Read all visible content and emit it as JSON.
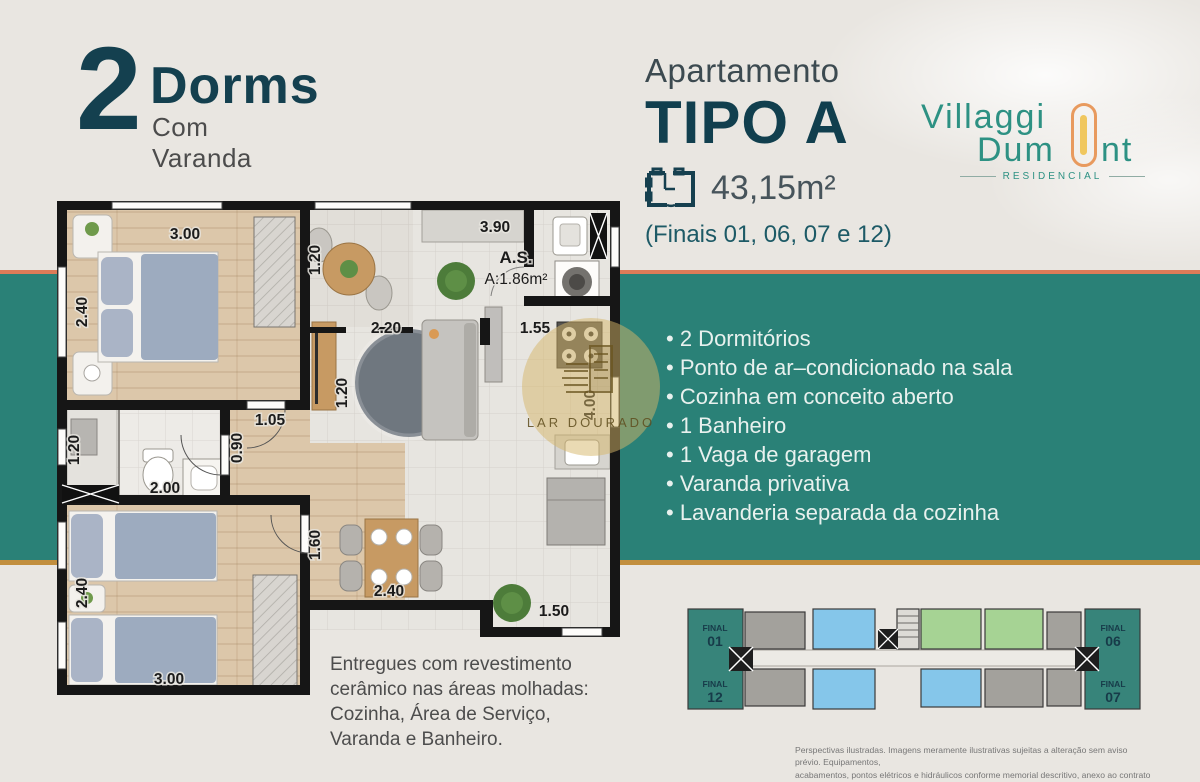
{
  "colors": {
    "background": "#e9e6e1",
    "band_teal": "#2a8177",
    "band_top_accent": "#dd7b58",
    "band_bottom_accent": "#c28f3e",
    "headline": "#14404f",
    "logo_teal": "#2d9183",
    "logo_orange": "#e89a5e",
    "logo_yellow": "#f0c75e",
    "keyplan_unit_blue": "#85c6ea",
    "keyplan_unit_green": "#a6d394",
    "keyplan_unit_gray": "#a3a19c",
    "keyplan_unit_teal": "#37847a"
  },
  "header_left": {
    "big_number": "2",
    "title": "Dorms",
    "subtitle": "Com Varanda"
  },
  "header_center": {
    "kicker": "Apartamento",
    "type": "TIPO A",
    "area": "43,15m²",
    "finals": "(Finais 01, 06, 07 e 12)"
  },
  "logo": {
    "word1": "Villaggi",
    "word2a": "Dum",
    "word2b": "nt",
    "tagline": "RESIDENCIAL"
  },
  "features": {
    "items": [
      "2 Dormitórios",
      "Ponto de ar–condicionado na sala",
      "Cozinha em conceito aberto",
      "1 Banheiro",
      "1 Vaga de garagem",
      "Varanda privativa",
      "Lavanderia separada da cozinha"
    ]
  },
  "floorplan": {
    "labels": {
      "bed1_top": "3.00",
      "bed1_left": "2.40",
      "varanda_w": "1.20",
      "kitchen_top": "3.90",
      "living_w": "2.20",
      "as_title": "A.S.",
      "as_area": "A:1.86m²",
      "kitchen_w": "1.55",
      "tv_wall": "1.20",
      "right_h": "4.00",
      "bath_h": "1.20",
      "bath_w": "2.00",
      "hall_w": "1.05",
      "hall_h": "0.90",
      "dining_h": "1.60",
      "dining_w": "2.40",
      "bed2_left": "2.40",
      "bed2_bottom": "3.00",
      "service_w": "1.50"
    }
  },
  "watermark": {
    "text": "LAR DOURADO"
  },
  "delivery_note": {
    "text": "Entregues com revestimento\ncerâmico nas áreas molhadas:\nCozinha, Área de Serviço,\nVaranda e Banheiro."
  },
  "keyplan": {
    "units": [
      {
        "label": "FINAL",
        "number": "01"
      },
      {
        "label": "FINAL",
        "number": "12"
      },
      {
        "label": "FINAL",
        "number": "06"
      },
      {
        "label": "FINAL",
        "number": "07"
      }
    ]
  },
  "disclaimer": {
    "text": "Perspectivas ilustradas. Imagens meramente ilustrativas sujeitas a alteração sem aviso prévio. Equipamentos,\nacabamentos, pontos elétricos e hidráulicos conforme memorial descritivo, anexo ao contrato de compra e venda."
  }
}
